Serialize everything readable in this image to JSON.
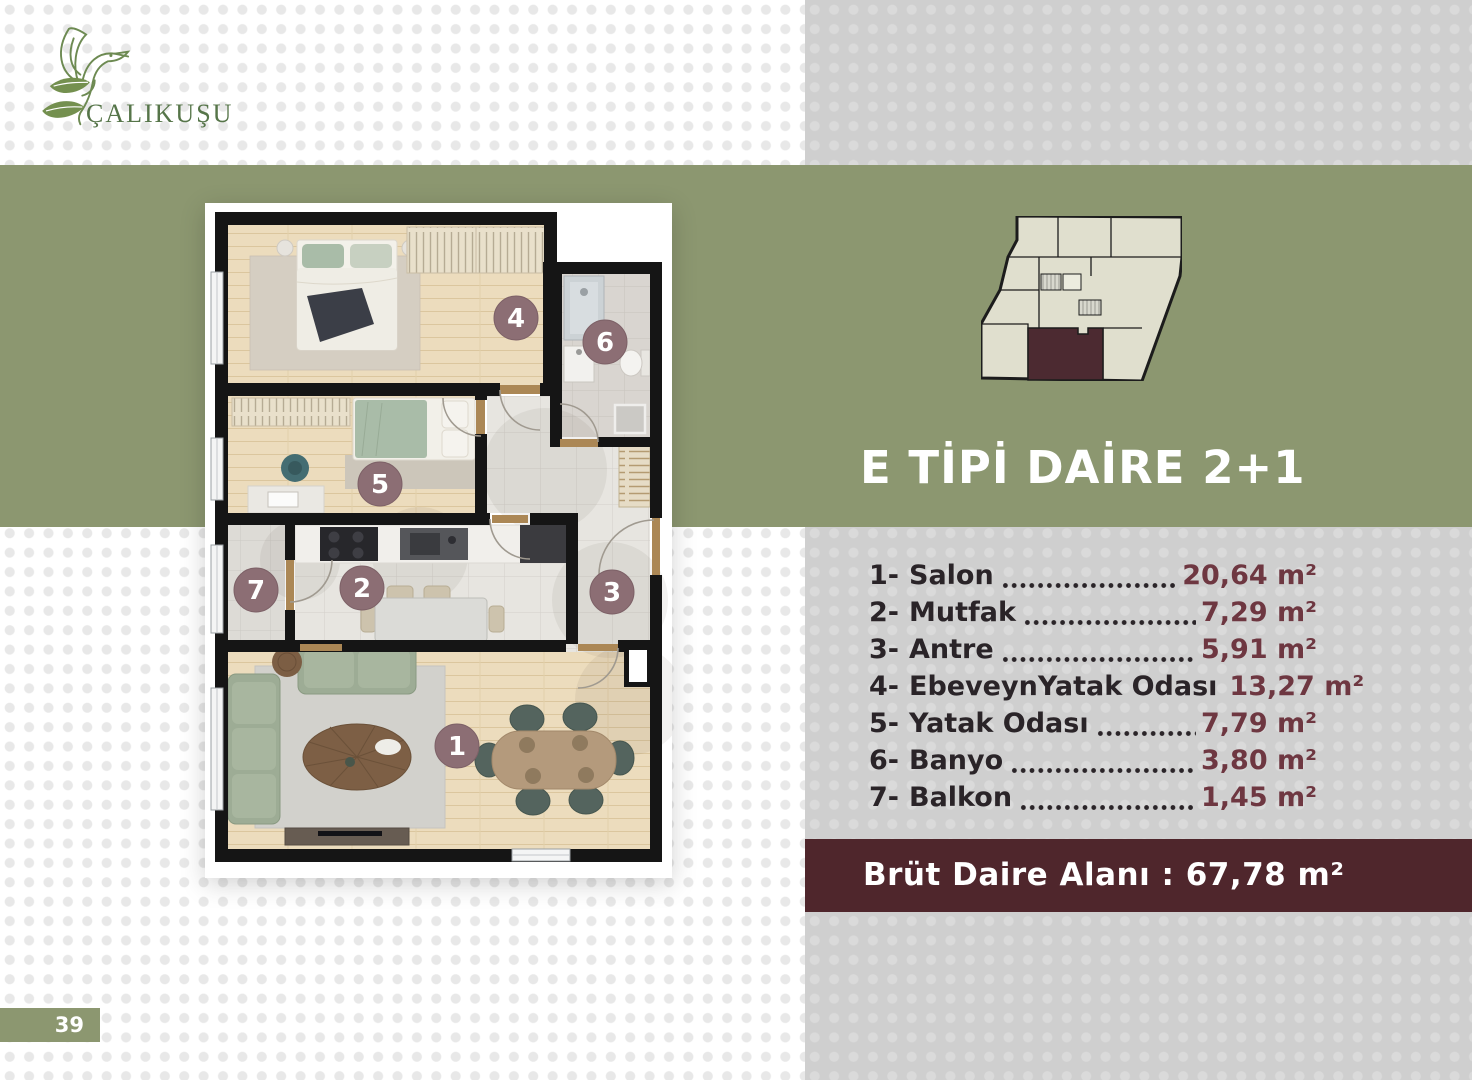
{
  "brand": {
    "name": "ÇALIKUŞU"
  },
  "page": {
    "number": "39"
  },
  "unit_panel": {
    "title": "E TİPİ DAİRE 2+1",
    "rooms": [
      {
        "num": "1-",
        "name": "Salon",
        "area": "20,64 m²"
      },
      {
        "num": "2-",
        "name": "Mutfak",
        "area": "7,29 m²"
      },
      {
        "num": "3-",
        "name": "Antre",
        "area": "5,91 m²"
      },
      {
        "num": "4-",
        "name": "EbeveynYatak Odası",
        "area": "13,27 m²"
      },
      {
        "num": "5-",
        "name": "Yatak Odası",
        "area": "7,79 m²"
      },
      {
        "num": "6-",
        "name": "Banyo",
        "area": "3,80 m²"
      },
      {
        "num": "7-",
        "name": "Balkon",
        "area": "1,45 m²"
      }
    ],
    "gross_area": "Brüt Daire Alanı : 67,78 m²"
  },
  "floorplan": {
    "badges": [
      "1",
      "2",
      "3",
      "4",
      "5",
      "6",
      "7"
    ]
  },
  "colors": {
    "olive": "#8c9770",
    "panel_gray": "#cfcfcf",
    "gross_bar": "#4f262c",
    "area_value": "#6e3741",
    "label_dark": "#2a2428",
    "badge": "#8c6e74",
    "logo_green": "#567549",
    "footprint_unit": "#4c2a31"
  }
}
